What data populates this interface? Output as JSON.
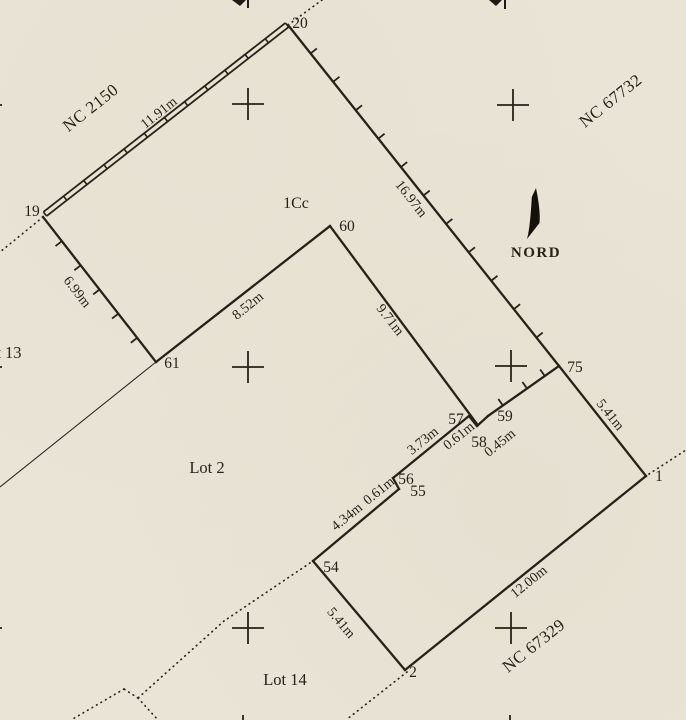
{
  "plan": {
    "north": {
      "label": "NORD"
    },
    "parcel_label": "1Cc",
    "neighbors": {
      "nw": "NC 2150",
      "ne": "NC 67732",
      "se": "NC 67329"
    },
    "lots": {
      "lot2": "Lot 2",
      "lot14": "Lot 14",
      "lot13": "Lot 13"
    },
    "points": {
      "p1": "1",
      "p2": "2",
      "p19": "19",
      "p20": "20",
      "p54": "54",
      "p55": "55",
      "p56": "56",
      "p57": "57",
      "p58": "58",
      "p59": "59",
      "p60": "60",
      "p61": "61",
      "p75": "75"
    },
    "dimensions": {
      "d19_20": "11.91m",
      "d20_75": "16.97m",
      "d19_61": "6.99m",
      "d61_60": "8.52m",
      "d60_58": "9.71m",
      "d75_1": "5.41m",
      "d58_59": "0.45m",
      "d57_58": "0.61m",
      "d56_57": "3.73m",
      "d55_56": "0.61m",
      "d54_55": "4.34m",
      "d54_2": "5.41m",
      "d1_2": "12.00m"
    }
  }
}
